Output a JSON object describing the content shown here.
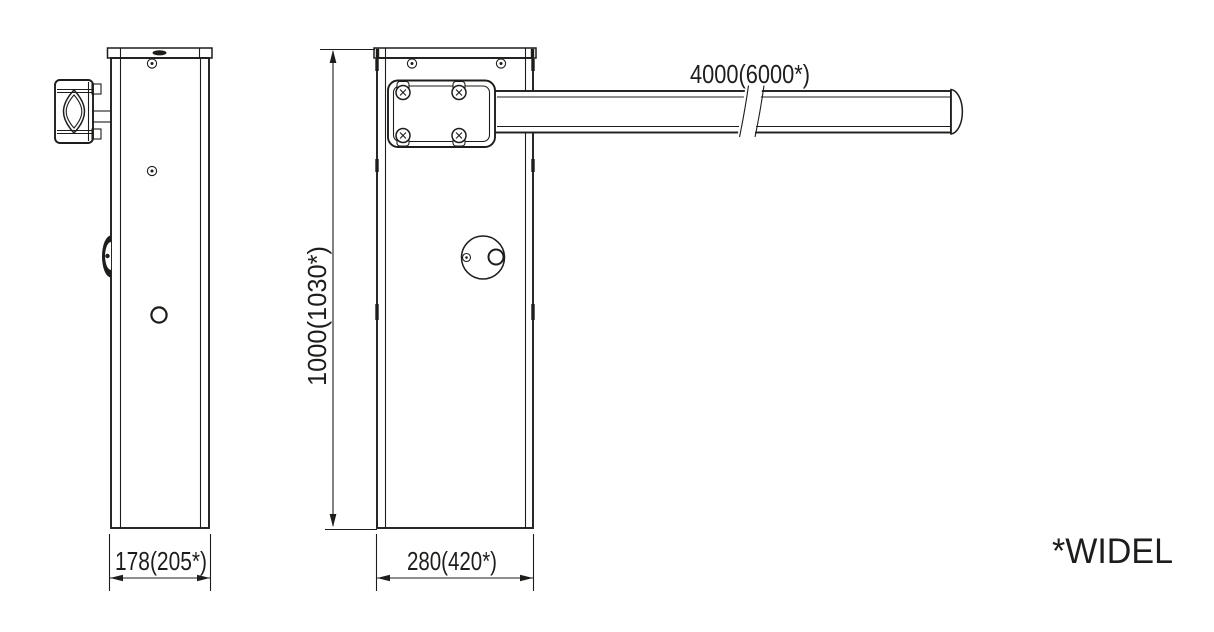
{
  "canvas": {
    "background": "#ffffff",
    "line_color": "#1d1d1b"
  },
  "dimensions": {
    "side_width": "178(205*)",
    "front_width": "280(420*)",
    "height": "1000(1030*)",
    "arm_length": "4000(6000*)"
  },
  "note": "*WIDEL"
}
